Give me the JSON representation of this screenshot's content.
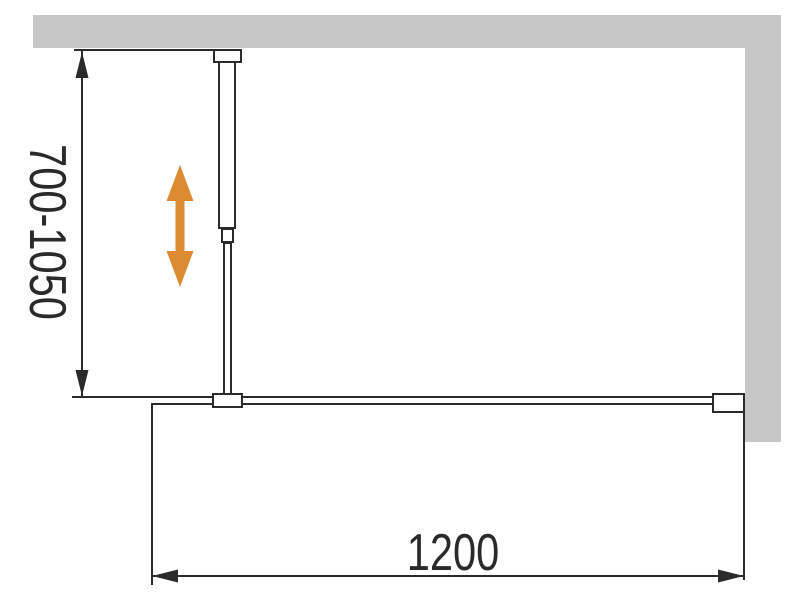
{
  "diagram": {
    "labels": {
      "height_range": "700-1050",
      "width": "1200"
    },
    "colors": {
      "wall_fill": "#C7C7C7",
      "line": "#2B2B2B",
      "adjust_arrow": "#DC8B31"
    }
  }
}
